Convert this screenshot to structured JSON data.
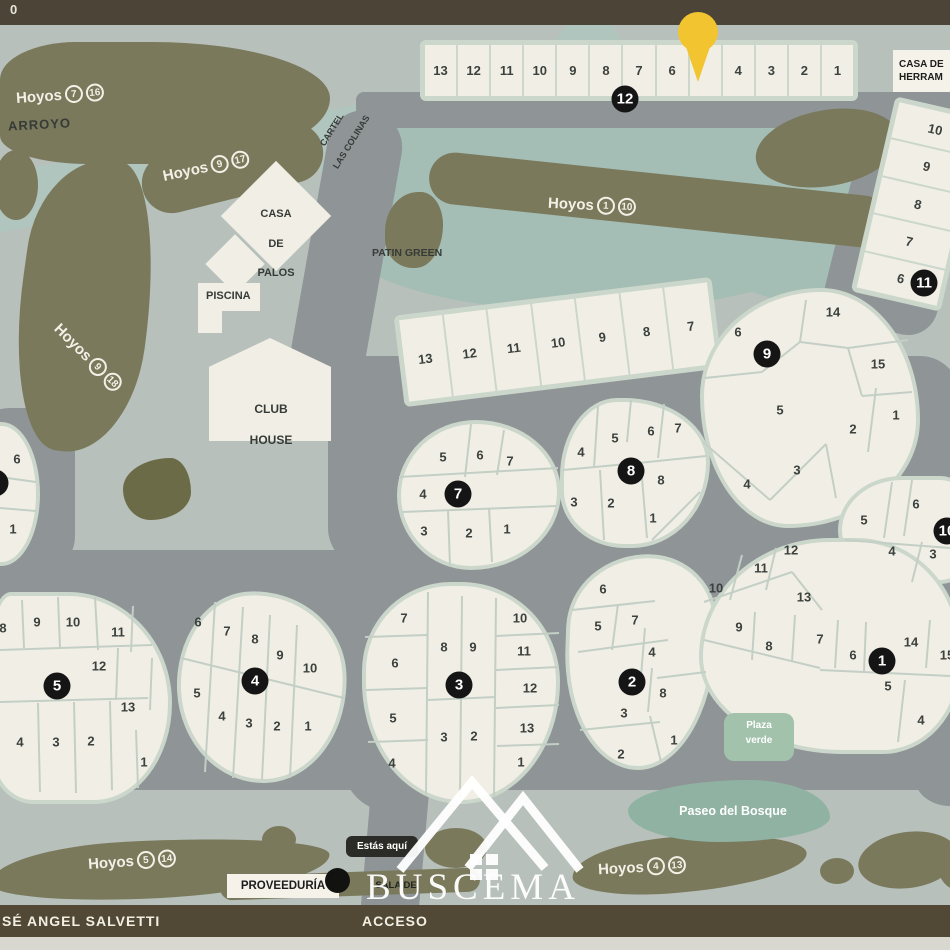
{
  "labels": {
    "top_partial": "0",
    "arroyo": "ARROYO",
    "cartel": [
      "CARTEL",
      "LAS COLINAS"
    ],
    "casa_palos": [
      "CASA",
      "DE",
      "PALOS"
    ],
    "piscina": "PISCINA",
    "club_house": [
      "CLUB",
      "HOUSE"
    ],
    "patin_green": "PATIN GREEN",
    "casa_herramientas": [
      "CASA DE",
      "HERRAM"
    ],
    "plaza_verde": [
      "Plaza",
      "verde"
    ],
    "paseo_bosque": "Paseo del Bosque",
    "proveeduria": "PROVEEDURÍA",
    "estas_aqui": "Estás aquí",
    "sala_monitoreo": [
      "SALA DE",
      "MONITOREO"
    ],
    "street_left": "SÉ ANGEL SALVETTI",
    "street_center": "ACCESO",
    "watermark": "BUSCEMA"
  },
  "hoyos": [
    {
      "word": "Hoyos",
      "a": "7",
      "b": "16"
    },
    {
      "word": "Hoyos",
      "a": "9",
      "b": "17"
    },
    {
      "word": "Hoyos",
      "a": "9",
      "b": "18"
    },
    {
      "word": "Hoyos",
      "a": "1",
      "b": "10"
    },
    {
      "word": "Hoyos",
      "a": "5",
      "b": "14"
    },
    {
      "word": "Hoyos",
      "a": "4",
      "b": "13"
    }
  ],
  "badges": [
    {
      "n": "12",
      "x": 625,
      "y": 99
    },
    {
      "n": "11",
      "x": 924,
      "y": 283
    },
    {
      "n": "9",
      "x": 767,
      "y": 354
    },
    {
      "n": "8",
      "x": 631,
      "y": 471
    },
    {
      "n": "7",
      "x": 458,
      "y": 494
    },
    {
      "n": "10",
      "x": 947,
      "y": 531
    },
    {
      "n": "",
      "x": -5,
      "y": 483
    },
    {
      "n": "5",
      "x": 57,
      "y": 686
    },
    {
      "n": "4",
      "x": 255,
      "y": 681
    },
    {
      "n": "3",
      "x": 459,
      "y": 685
    },
    {
      "n": "2",
      "x": 632,
      "y": 682
    },
    {
      "n": "1",
      "x": 882,
      "y": 661
    }
  ],
  "blocks": [
    {
      "id": "g12",
      "number": "12",
      "type": "grid",
      "lots": [
        "13",
        "12",
        "11",
        "10",
        "9",
        "8",
        "7",
        "6",
        "",
        "4",
        "3",
        "2",
        "1"
      ]
    },
    {
      "id": "g11",
      "number": "11",
      "type": "grid",
      "lots": [
        "10",
        "9",
        "8",
        "7",
        "6"
      ]
    },
    {
      "id": "g9row",
      "number": "9",
      "type": "grid",
      "lots": [
        "13",
        "12",
        "11",
        "10",
        "9",
        "8",
        "7"
      ]
    },
    {
      "id": "b9",
      "number": "9",
      "type": "free",
      "lots": [
        {
          "n": "6",
          "x": 738,
          "y": 332
        },
        {
          "n": "14",
          "x": 833,
          "y": 312
        },
        {
          "n": "15",
          "x": 878,
          "y": 364
        },
        {
          "n": "5",
          "x": 780,
          "y": 410
        },
        {
          "n": "2",
          "x": 853,
          "y": 429
        },
        {
          "n": "1",
          "x": 896,
          "y": 415
        },
        {
          "n": "3",
          "x": 797,
          "y": 470
        },
        {
          "n": "4",
          "x": 747,
          "y": 484
        }
      ]
    },
    {
      "id": "b7",
      "number": "7",
      "type": "free",
      "lots": [
        {
          "n": "5",
          "x": 443,
          "y": 457
        },
        {
          "n": "6",
          "x": 480,
          "y": 455
        },
        {
          "n": "7",
          "x": 510,
          "y": 461
        },
        {
          "n": "4",
          "x": 423,
          "y": 494
        },
        {
          "n": "3",
          "x": 424,
          "y": 531
        },
        {
          "n": "2",
          "x": 469,
          "y": 533
        },
        {
          "n": "1",
          "x": 507,
          "y": 529
        }
      ]
    },
    {
      "id": "b8",
      "number": "8",
      "type": "free",
      "lots": [
        {
          "n": "4",
          "x": 581,
          "y": 452
        },
        {
          "n": "5",
          "x": 615,
          "y": 438
        },
        {
          "n": "6",
          "x": 651,
          "y": 431
        },
        {
          "n": "7",
          "x": 678,
          "y": 428
        },
        {
          "n": "8",
          "x": 661,
          "y": 480
        },
        {
          "n": "3",
          "x": 574,
          "y": 502
        },
        {
          "n": "2",
          "x": 611,
          "y": 503
        },
        {
          "n": "1",
          "x": 653,
          "y": 518
        }
      ]
    },
    {
      "id": "b10",
      "number": "10",
      "type": "free",
      "lots": [
        {
          "n": "6",
          "x": 916,
          "y": 504
        },
        {
          "n": "5",
          "x": 864,
          "y": 520
        },
        {
          "n": "4",
          "x": 892,
          "y": 551
        },
        {
          "n": "3",
          "x": 933,
          "y": 554
        }
      ]
    },
    {
      "id": "b6l",
      "number": "",
      "type": "free",
      "lots": [
        {
          "n": "6",
          "x": 17,
          "y": 459
        },
        {
          "n": "1",
          "x": 13,
          "y": 529
        }
      ]
    },
    {
      "id": "b5",
      "number": "5",
      "type": "free",
      "lots": [
        {
          "n": "8",
          "x": 3,
          "y": 628
        },
        {
          "n": "9",
          "x": 37,
          "y": 622
        },
        {
          "n": "10",
          "x": 73,
          "y": 622
        },
        {
          "n": "11",
          "x": 118,
          "y": 632
        },
        {
          "n": "12",
          "x": 99,
          "y": 666
        },
        {
          "n": "13",
          "x": 128,
          "y": 707
        },
        {
          "n": "4",
          "x": 20,
          "y": 742
        },
        {
          "n": "3",
          "x": 56,
          "y": 742
        },
        {
          "n": "2",
          "x": 91,
          "y": 741
        },
        {
          "n": "1",
          "x": 144,
          "y": 762
        }
      ]
    },
    {
      "id": "b4",
      "number": "4",
      "type": "free",
      "lots": [
        {
          "n": "6",
          "x": 198,
          "y": 622
        },
        {
          "n": "7",
          "x": 227,
          "y": 631
        },
        {
          "n": "8",
          "x": 255,
          "y": 639
        },
        {
          "n": "9",
          "x": 280,
          "y": 655
        },
        {
          "n": "10",
          "x": 310,
          "y": 668
        },
        {
          "n": "5",
          "x": 197,
          "y": 693
        },
        {
          "n": "4",
          "x": 222,
          "y": 716
        },
        {
          "n": "3",
          "x": 249,
          "y": 723
        },
        {
          "n": "2",
          "x": 277,
          "y": 726
        },
        {
          "n": "1",
          "x": 308,
          "y": 726
        }
      ]
    },
    {
      "id": "b3",
      "number": "3",
      "type": "free",
      "lots": [
        {
          "n": "7",
          "x": 404,
          "y": 618
        },
        {
          "n": "10",
          "x": 520,
          "y": 618
        },
        {
          "n": "8",
          "x": 444,
          "y": 647
        },
        {
          "n": "9",
          "x": 473,
          "y": 647
        },
        {
          "n": "6",
          "x": 395,
          "y": 663
        },
        {
          "n": "11",
          "x": 524,
          "y": 651
        },
        {
          "n": "12",
          "x": 530,
          "y": 688
        },
        {
          "n": "5",
          "x": 393,
          "y": 718
        },
        {
          "n": "13",
          "x": 527,
          "y": 728
        },
        {
          "n": "3",
          "x": 444,
          "y": 737
        },
        {
          "n": "2",
          "x": 474,
          "y": 736
        },
        {
          "n": "4",
          "x": 392,
          "y": 763
        },
        {
          "n": "1",
          "x": 521,
          "y": 762
        }
      ]
    },
    {
      "id": "b2",
      "number": "2",
      "type": "free",
      "lots": [
        {
          "n": "6",
          "x": 603,
          "y": 589
        },
        {
          "n": "5",
          "x": 598,
          "y": 626
        },
        {
          "n": "7",
          "x": 635,
          "y": 620
        },
        {
          "n": "4",
          "x": 652,
          "y": 652
        },
        {
          "n": "8",
          "x": 663,
          "y": 693
        },
        {
          "n": "3",
          "x": 624,
          "y": 713
        },
        {
          "n": "2",
          "x": 621,
          "y": 754
        },
        {
          "n": "1",
          "x": 674,
          "y": 740
        }
      ]
    },
    {
      "id": "b1",
      "number": "1",
      "type": "free",
      "lots": [
        {
          "n": "12",
          "x": 791,
          "y": 550
        },
        {
          "n": "11",
          "x": 761,
          "y": 568
        },
        {
          "n": "10",
          "x": 716,
          "y": 588
        },
        {
          "n": "13",
          "x": 804,
          "y": 597
        },
        {
          "n": "9",
          "x": 739,
          "y": 627
        },
        {
          "n": "8",
          "x": 769,
          "y": 646
        },
        {
          "n": "7",
          "x": 820,
          "y": 639
        },
        {
          "n": "6",
          "x": 853,
          "y": 655
        },
        {
          "n": "14",
          "x": 911,
          "y": 642
        },
        {
          "n": "15",
          "x": 947,
          "y": 655
        },
        {
          "n": "5",
          "x": 888,
          "y": 686
        },
        {
          "n": "4",
          "x": 921,
          "y": 720
        }
      ]
    }
  ],
  "colors": {
    "pin": "#f2c430",
    "road": "#8f9496",
    "lake": "#a4bdb5",
    "lot": "#f1efe5",
    "vegetation": "#7a795b",
    "background": "#b7c0bb",
    "bar": "#4c4537",
    "plaza_verde": "#a3c2ab",
    "paseo": "#8fb2a3"
  }
}
